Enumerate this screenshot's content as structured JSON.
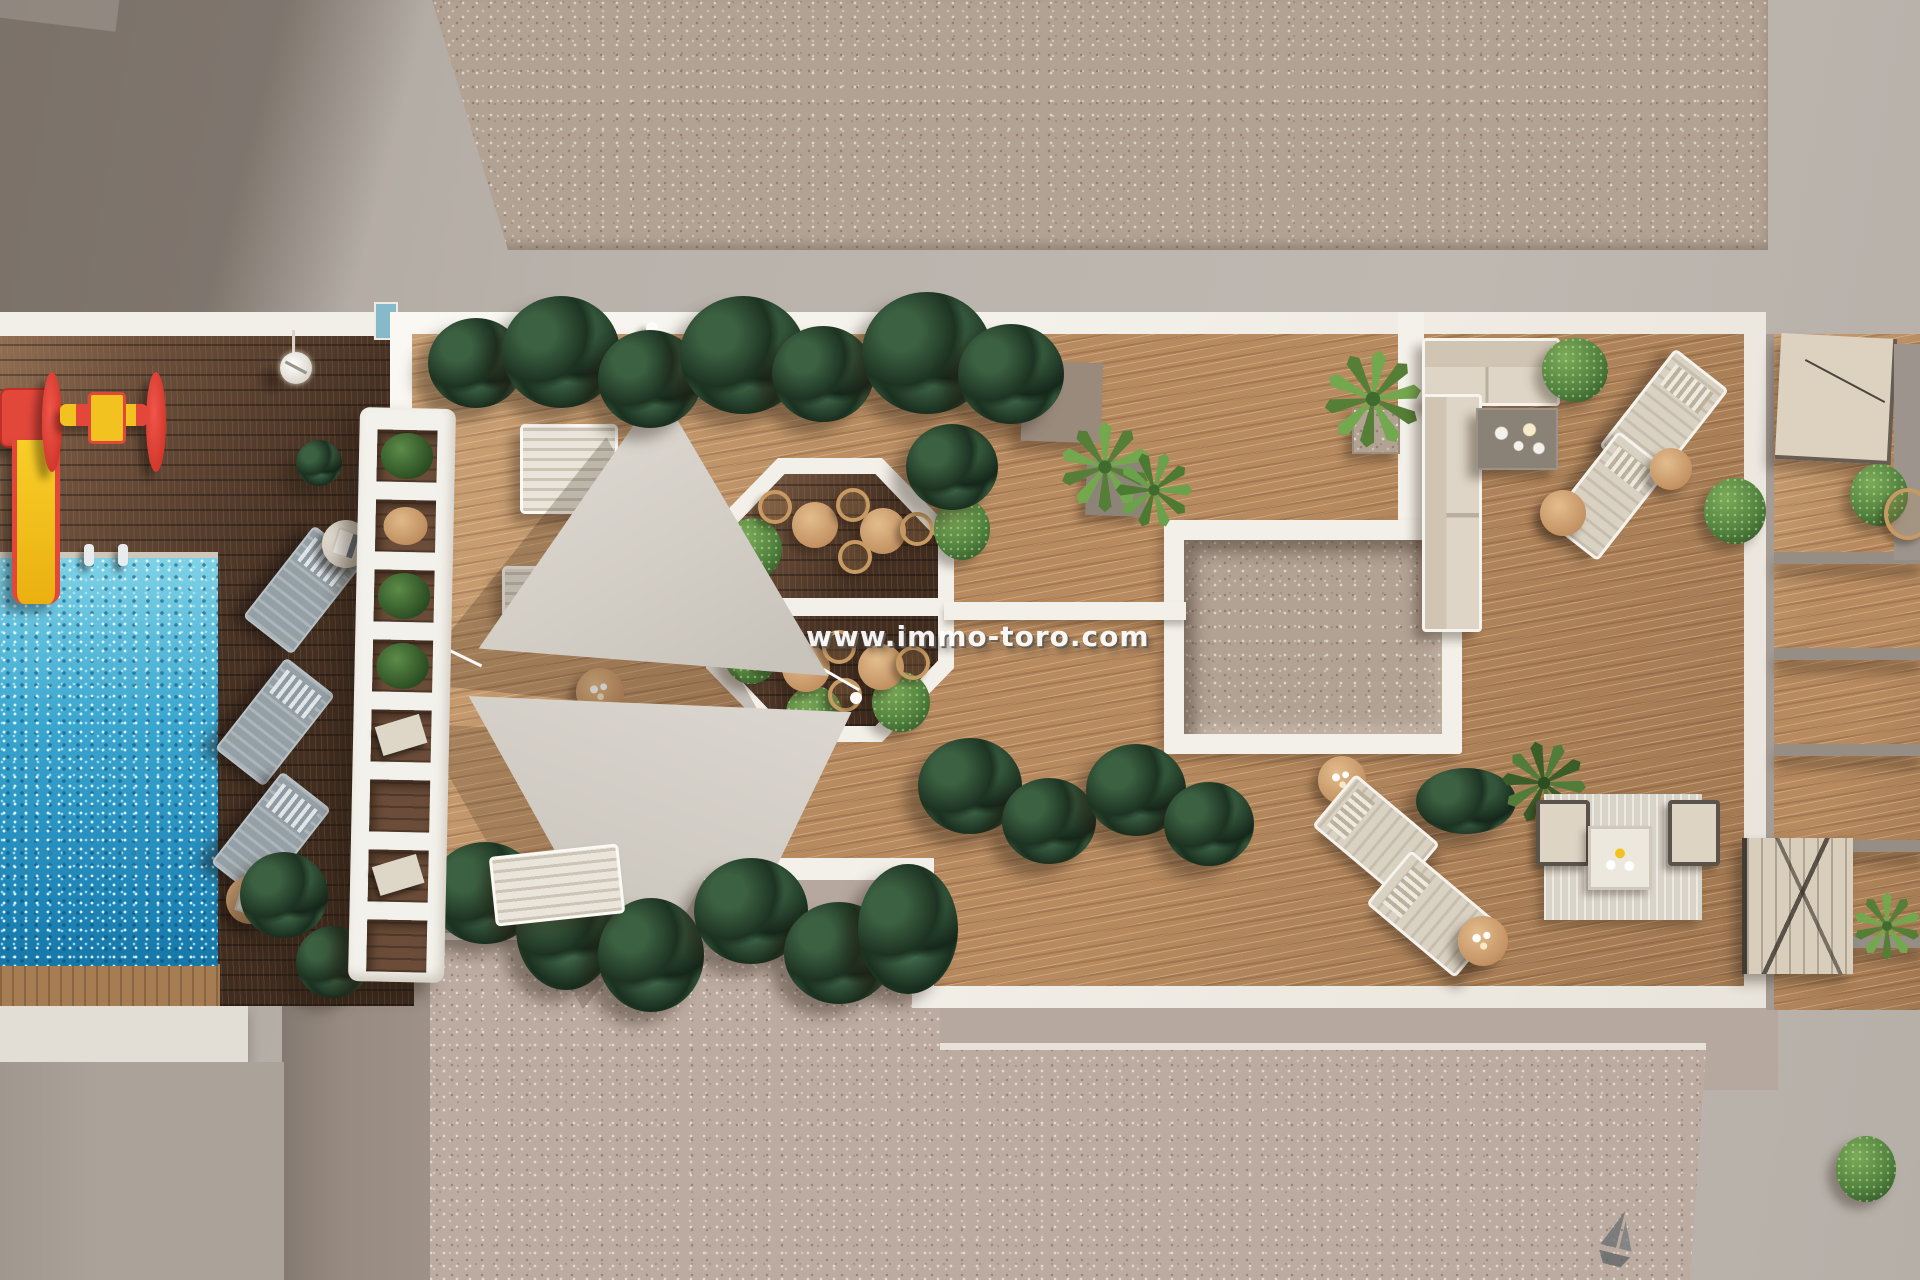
{
  "meta": {
    "type": "aerial-3d-architectural-render",
    "description": "Top-down 3D rendering of a residential communal deck: swimming pool, kids playground, shaded wooden pool deck, white slatted pergola, sun deck with two triangular shade sails, octagonal dining patio, gravel light-well, corner lounge terrace with sofa and sun loungers, private terraces and gravel roof strips.",
    "watermark": "www.immo-toro.com"
  },
  "icons": {
    "sailboat": "sailboat-icon",
    "pole_light": "pole-light-icon"
  },
  "palette": {
    "concrete": "#b9b2ab",
    "concrete_pink": "#b7a89f",
    "gravel_top": "#b2a294",
    "gravel_bottom": "#bcaba0",
    "white_trim": "#f4f1ea",
    "deck_wood_light": "#b78a5f",
    "deck_wood_dark": "#5d4332",
    "pool_water": "#2e97c6",
    "sail_fabric": "#d7d2ca",
    "foliage_dark": "#24402a",
    "foliage_bright": "#5f944a",
    "rattan": "#c69a62",
    "playground_red": "#e2473a",
    "playground_yellow": "#f2c220"
  },
  "regions": {
    "pool": "swimming-pool",
    "playground": "kids-playground",
    "pool_deck": "shaded-pool-deck",
    "pergola": "white-slatted-pergola",
    "sun_deck": "main-sun-deck",
    "shade_sails": "triangular-shade-sails",
    "octagon": "octagonal-dining-patio",
    "atrium": "gravel-light-well",
    "lounge": "corner-lounge-terrace",
    "terraces": "private-terraces"
  }
}
